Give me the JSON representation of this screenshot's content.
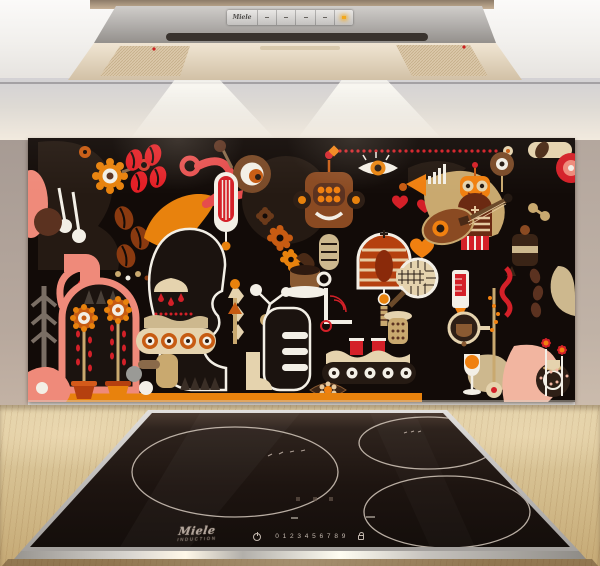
{
  "scene_title": "Kitchen splashback with abstract coffee artwork above induction hob",
  "hood": {
    "brand": "Miele",
    "buttons": [
      "power-button",
      "fan-speed-1",
      "fan-speed-2",
      "fan-speed-3",
      "light-button"
    ],
    "indicator_color": "#f2a81c"
  },
  "splashback": {
    "artwork_title": "Abstract coffee composition",
    "background_color": "#120b08",
    "palette": [
      "#e31e25",
      "#d42028",
      "#f08010",
      "#e8820d",
      "#c75b12",
      "#b5400f",
      "#ef8a7a",
      "#f2b5a0",
      "#e5d3ae",
      "#c9a96f",
      "#8a4a22",
      "#5b3220",
      "#251a13",
      "#f3efe6"
    ],
    "motifs": [
      "coffee-beans",
      "red-coffee-beans",
      "flowers-in-pots",
      "gear-flower",
      "gears",
      "robot-head",
      "profile-face-silhouette",
      "coffee-cup-and-saucer",
      "striped-dome-machine",
      "conveyor-belt-with-red-cups",
      "hearts",
      "eye",
      "guitar",
      "measuring-cylinder",
      "portafilter",
      "goblet-with-orange-ball",
      "pinwheel-flowers",
      "red-dotted-line",
      "tennis-racket",
      "chandelier-with-drops"
    ]
  },
  "cooktop": {
    "brand": "Miele",
    "model_line": "INDUCTION",
    "power_levels": [
      "0",
      "1",
      "2",
      "3",
      "4",
      "5",
      "6",
      "7",
      "8",
      "9"
    ],
    "zone_count": 3
  },
  "materials": {
    "wall_color": "#b3a79e",
    "counter_color": "#d7c297",
    "steel_color": "#b5b2af",
    "glass_color": "#1d1512"
  }
}
